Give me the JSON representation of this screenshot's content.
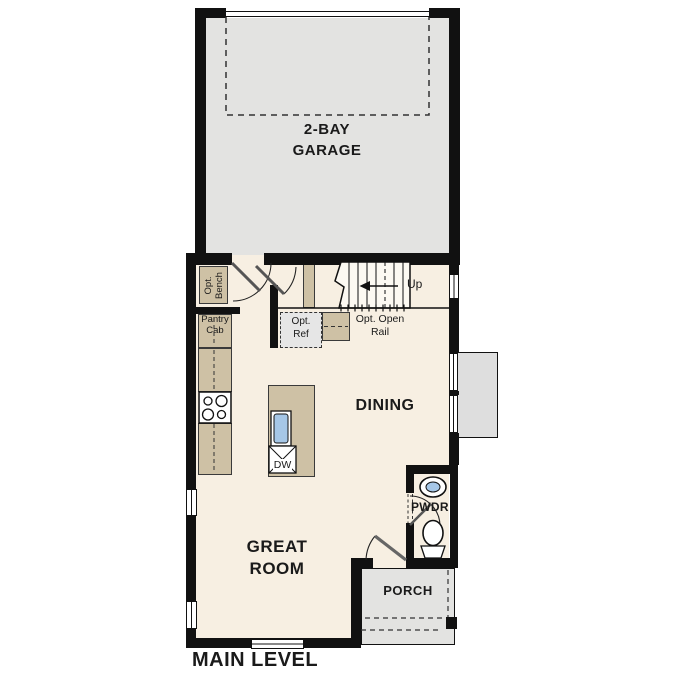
{
  "plan": {
    "title": "MAIN LEVEL",
    "rooms": {
      "garage": "2-BAY\nGARAGE",
      "dining": "DINING",
      "great_room": "GREAT\nROOM",
      "powder": "PWDR",
      "porch": "PORCH"
    },
    "annotations": {
      "opt_bench": "Opt.\nBench",
      "pantry_cab": "Pantry\nCab",
      "opt_ref": "Opt.\nRef",
      "opt_open_rail": "Opt. Open\nRail",
      "stairs_direction": "Up",
      "dishwasher": "DW"
    },
    "colors": {
      "wall": "#111111",
      "floor": "#f7efe2",
      "garage_floor": "#e3e3e1",
      "porch_floor": "#e3e3e1",
      "cabinet": "#cec1a5",
      "bumpout": "#dedede",
      "opt_ref_fill": "#e6e6e6",
      "sink_blue": "#a6c7e7"
    }
  }
}
